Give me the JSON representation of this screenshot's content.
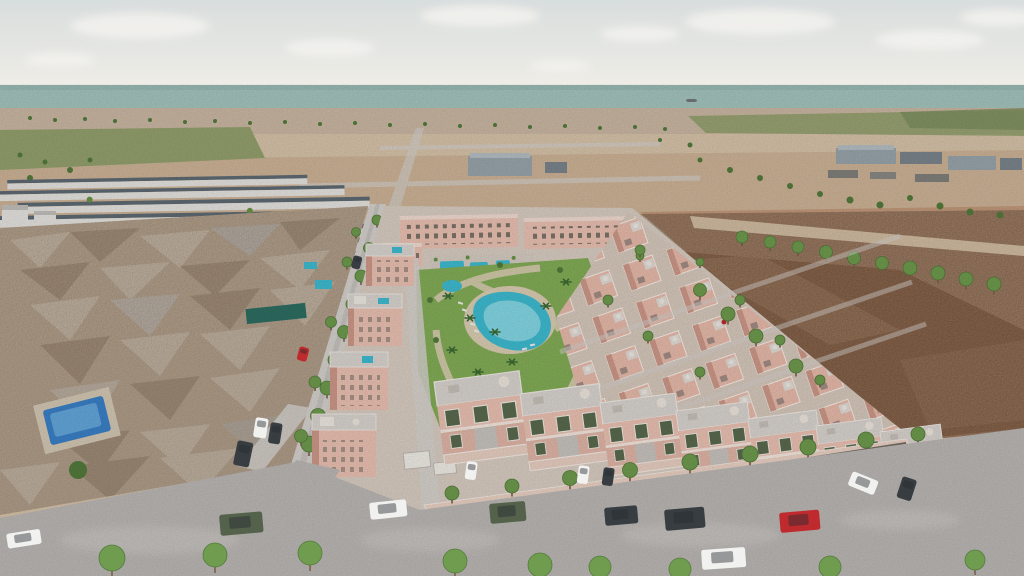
{
  "meta": {
    "description": "Aerial 3D render of a coastal residential development: pink villas and townhouses around a landscaped park with lagoon pool, older low-poly neighborhood and white row-houses to the west, empty dirt lot to the east, sandy plains, a green field belt and the sea on the horizon with one ship."
  },
  "palette": {
    "sky_top": "#d8dddd",
    "sky_horizon": "#efede7",
    "cloud": "#f3f2ef",
    "sea": "#a6c6bf",
    "sea_shadow": "#98bab3",
    "ship": "#676c6b",
    "shore_town": "#ccb9a4",
    "sand_light": "#d9c5ab",
    "sand": "#cbae90",
    "sand_warm": "#c49a78",
    "green_field": "#95a26e",
    "green_field_dark": "#7e9060",
    "dirt": "#a87a5b",
    "dirt_light": "#c49a7b",
    "road": "#bdb9b6",
    "road_light": "#d7d3cf",
    "sidewalk": "#d3cec9",
    "curb": "#58534d",
    "old_town": "#c6b19a",
    "old_town_light": "#e0d2c0",
    "old_town_dark": "#a68f79",
    "white_wall": "#e8e6e2",
    "slate_roof": "#5f6b74",
    "pink_wall": "#ecc3b4",
    "pink_roof": "#e9bcac",
    "pink_wall_shade": "#cf9a8a",
    "pink_light": "#f3ddd2",
    "terrace": "#dbd6d1",
    "window_green": "#5a6b4e",
    "window_dark": "#3f474d",
    "lawn": "#84ae57",
    "lawn_dark": "#6b9447",
    "path": "#dccfb4",
    "pool": "#3fbdd3",
    "pool_light": "#90dee9",
    "old_pool": "#3b82c9",
    "palm": "#3c6a33",
    "tree": "#6f9c4e",
    "tree_dark": "#547c3c",
    "trunk": "#7d6148",
    "industrial": "#9aa6ad",
    "industrial_dark": "#7c868d",
    "car_white": "#f1f1ef",
    "car_dark": "#383d41",
    "car_red": "#bf2a2e",
    "car_green": "#55624b"
  },
  "scene": {
    "horizon_y": 85,
    "inventory": {
      "lagoon_pool": 1,
      "kids_pool": 1,
      "communal_pools": 3,
      "rooftop_pools": 2,
      "old_town_pools": 3,
      "apartment_blocks": 3,
      "villa_rows": 4,
      "front_townhouses": 7,
      "ship_on_sea": 1
    },
    "cars": [
      {
        "color": "car_white",
        "x": 6,
        "y": 534,
        "w": 34,
        "h": 15,
        "rot": -9
      },
      {
        "color": "car_green",
        "x": 219,
        "y": 515,
        "w": 43,
        "h": 21,
        "rot": -5
      },
      {
        "color": "car_white",
        "x": 369,
        "y": 503,
        "w": 37,
        "h": 17,
        "rot": -6
      },
      {
        "color": "car_green",
        "x": 489,
        "y": 504,
        "w": 36,
        "h": 20,
        "rot": -5
      },
      {
        "color": "car_dark",
        "x": 604,
        "y": 508,
        "w": 33,
        "h": 18,
        "rot": -5
      },
      {
        "color": "car_dark",
        "x": 664,
        "y": 510,
        "w": 40,
        "h": 21,
        "rot": -5
      },
      {
        "color": "car_red",
        "x": 779,
        "y": 513,
        "w": 40,
        "h": 20,
        "rot": -5
      },
      {
        "color": "car_white",
        "x": 701,
        "y": 550,
        "w": 44,
        "h": 20,
        "rot": -4
      },
      {
        "color": "car_white",
        "x": 256,
        "y": 417,
        "w": 13,
        "h": 20,
        "rot": 9
      },
      {
        "color": "car_dark",
        "x": 271,
        "y": 422,
        "w": 12,
        "h": 21,
        "rot": 9
      },
      {
        "color": "car_dark",
        "x": 238,
        "y": 440,
        "w": 16,
        "h": 25,
        "rot": 12
      },
      {
        "color": "car_white",
        "x": 853,
        "y": 471,
        "w": 28,
        "h": 15,
        "rot": 22
      },
      {
        "color": "car_dark",
        "x": 903,
        "y": 476,
        "w": 15,
        "h": 22,
        "rot": 18
      },
      {
        "color": "car_dark",
        "x": 354,
        "y": 255,
        "w": 9,
        "h": 13,
        "rot": 15
      },
      {
        "color": "car_red",
        "x": 300,
        "y": 346,
        "w": 10,
        "h": 14,
        "rot": 15
      },
      {
        "color": "car_white",
        "x": 467,
        "y": 461,
        "w": 11,
        "h": 18,
        "rot": 8
      },
      {
        "color": "car_white",
        "x": 579,
        "y": 465,
        "w": 11,
        "h": 18,
        "rot": 8
      },
      {
        "color": "car_dark",
        "x": 604,
        "y": 467,
        "w": 11,
        "h": 18,
        "rot": 8
      },
      {
        "color": "ship",
        "x": 686,
        "y": 99,
        "w": 11,
        "h": 3,
        "rot": 0
      }
    ],
    "trees": {
      "street": [
        [
          377,
          220,
          5
        ],
        [
          369,
          248,
          5.5
        ],
        [
          361,
          276,
          6
        ],
        [
          352,
          304,
          6
        ],
        [
          344,
          332,
          6.5
        ],
        [
          335,
          360,
          7
        ],
        [
          327,
          388,
          7
        ],
        [
          318,
          416,
          7.5
        ],
        [
          309,
          444,
          8
        ],
        [
          356,
          232,
          4.5
        ],
        [
          347,
          262,
          5
        ],
        [
          331,
          322,
          5.5
        ],
        [
          315,
          382,
          6
        ],
        [
          301,
          436,
          6.5
        ]
      ],
      "sidewalk": [
        [
          452,
          493,
          7
        ],
        [
          512,
          486,
          7
        ],
        [
          570,
          478,
          7.5
        ],
        [
          630,
          470,
          7.5
        ],
        [
          690,
          462,
          8
        ],
        [
          750,
          454,
          8
        ],
        [
          808,
          447,
          8
        ],
        [
          866,
          440,
          8
        ],
        [
          918,
          434,
          7
        ]
      ],
      "bottom": [
        [
          112,
          558,
          13
        ],
        [
          215,
          555,
          12
        ],
        [
          310,
          553,
          12
        ],
        [
          455,
          561,
          12
        ],
        [
          540,
          565,
          12
        ],
        [
          600,
          567,
          11
        ],
        [
          680,
          569,
          11
        ],
        [
          830,
          567,
          11
        ],
        [
          975,
          560,
          10
        ]
      ],
      "lot_row": [
        [
          742,
          237,
          6
        ],
        [
          770,
          242,
          6
        ],
        [
          798,
          247,
          6
        ],
        [
          826,
          252,
          6.5
        ],
        [
          854,
          258,
          6.5
        ],
        [
          882,
          263,
          6.5
        ],
        [
          910,
          268,
          7
        ],
        [
          938,
          273,
          7
        ],
        [
          966,
          279,
          7
        ],
        [
          994,
          284,
          7
        ]
      ],
      "boundary": [
        [
          700,
          290,
          6.5
        ],
        [
          728,
          314,
          7
        ],
        [
          756,
          336,
          7
        ],
        [
          796,
          366,
          7
        ],
        [
          640,
          250,
          5
        ]
      ],
      "villas_in": [
        [
          608,
          300,
          5
        ],
        [
          648,
          336,
          5
        ],
        [
          700,
          372,
          5
        ],
        [
          640,
          256,
          4
        ],
        [
          740,
          300,
          5
        ],
        [
          780,
          340,
          5
        ],
        [
          820,
          380,
          5
        ],
        [
          700,
          262,
          4
        ]
      ],
      "far": [
        [
          30,
          118,
          2
        ],
        [
          55,
          120,
          2
        ],
        [
          85,
          119,
          2
        ],
        [
          115,
          121,
          2
        ],
        [
          150,
          120,
          2
        ],
        [
          185,
          122,
          2
        ],
        [
          215,
          121,
          2
        ],
        [
          250,
          123,
          2
        ],
        [
          285,
          122,
          2
        ],
        [
          320,
          124,
          2
        ],
        [
          355,
          123,
          2
        ],
        [
          390,
          125,
          2
        ],
        [
          425,
          124,
          2
        ],
        [
          460,
          126,
          2
        ],
        [
          495,
          125,
          2
        ],
        [
          530,
          127,
          2
        ],
        [
          565,
          126,
          2
        ],
        [
          600,
          128,
          2
        ],
        [
          635,
          127,
          2
        ],
        [
          665,
          129,
          2
        ],
        [
          700,
          160,
          2.5
        ],
        [
          730,
          170,
          3
        ],
        [
          760,
          178,
          3
        ],
        [
          790,
          186,
          3
        ],
        [
          820,
          194,
          3
        ],
        [
          850,
          200,
          3.5
        ],
        [
          880,
          205,
          3.5
        ],
        [
          910,
          198,
          3
        ],
        [
          940,
          206,
          3.5
        ],
        [
          970,
          212,
          3.5
        ],
        [
          1000,
          215,
          3.5
        ],
        [
          20,
          155,
          2.5
        ],
        [
          45,
          162,
          2.5
        ],
        [
          70,
          170,
          3
        ],
        [
          30,
          178,
          3
        ],
        [
          60,
          185,
          3
        ],
        [
          90,
          160,
          2.5
        ],
        [
          660,
          140,
          2
        ],
        [
          690,
          145,
          2.5
        ]
      ],
      "park_edge": [
        [
          430,
          300,
          3
        ],
        [
          436,
          340,
          3
        ],
        [
          444,
          390,
          3
        ],
        [
          470,
          430,
          3.5
        ],
        [
          520,
          446,
          3.5
        ],
        [
          564,
          420,
          3.5
        ],
        [
          590,
          380,
          3
        ],
        [
          594,
          320,
          3
        ],
        [
          560,
          270,
          3
        ],
        [
          500,
          265,
          3
        ],
        [
          78,
          470,
          9
        ]
      ]
    },
    "palms": [
      [
        448,
        296
      ],
      [
        470,
        318
      ],
      [
        452,
        350
      ],
      [
        478,
        372
      ],
      [
        512,
        362
      ],
      [
        546,
        306
      ],
      [
        566,
        282
      ],
      [
        495,
        332
      ]
    ]
  }
}
